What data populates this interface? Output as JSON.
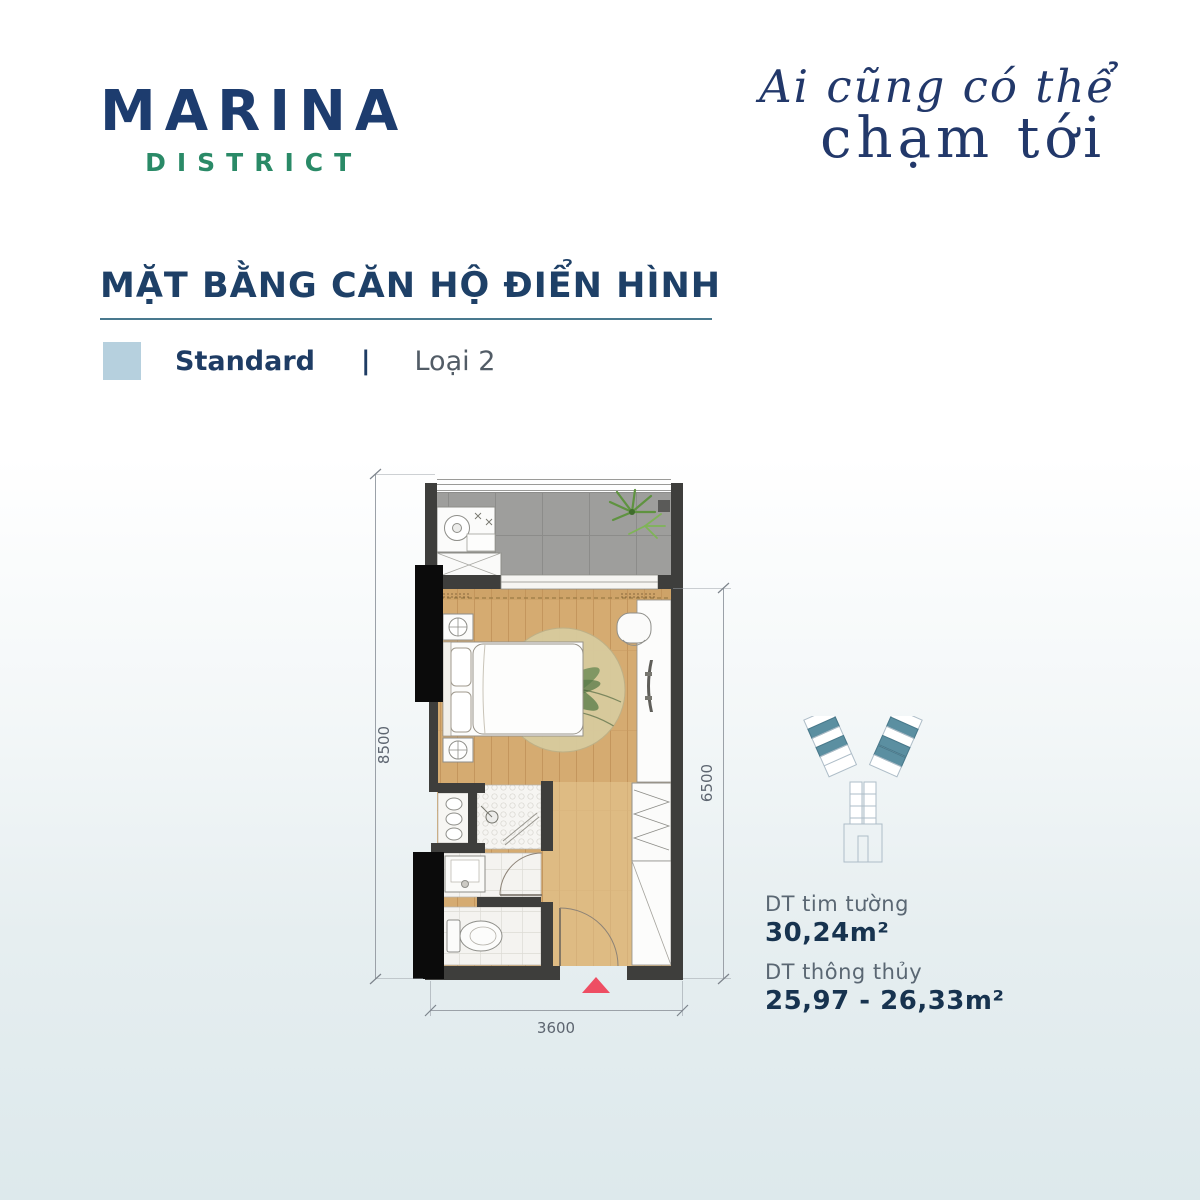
{
  "brand": {
    "name": "MARINA",
    "tag": "DISTRICT"
  },
  "tagline": {
    "line1": "Ai cũng có thể",
    "line2": "chạm tới"
  },
  "section": {
    "title": "MẶT BẰNG CĂN HỘ ĐIỂN HÌNH"
  },
  "legend": {
    "type": "Standard",
    "sep": "|",
    "variant": "Loại 2",
    "swatch_color": "#b6d0de"
  },
  "plan": {
    "dim_left": "8500",
    "dim_right": "6500",
    "dim_bottom": "3600"
  },
  "areas": {
    "label1": "DT tim tường",
    "value1": "30,24m²",
    "label2": "DT thông thủy",
    "value2": "25,97 - 26,33m²"
  },
  "colors": {
    "navy": "#1d3c6e",
    "green": "#2a8a67",
    "underline": "#49798e",
    "teal_highlight": "#5b8fa1",
    "entry_arrow": "#ee4e63"
  }
}
